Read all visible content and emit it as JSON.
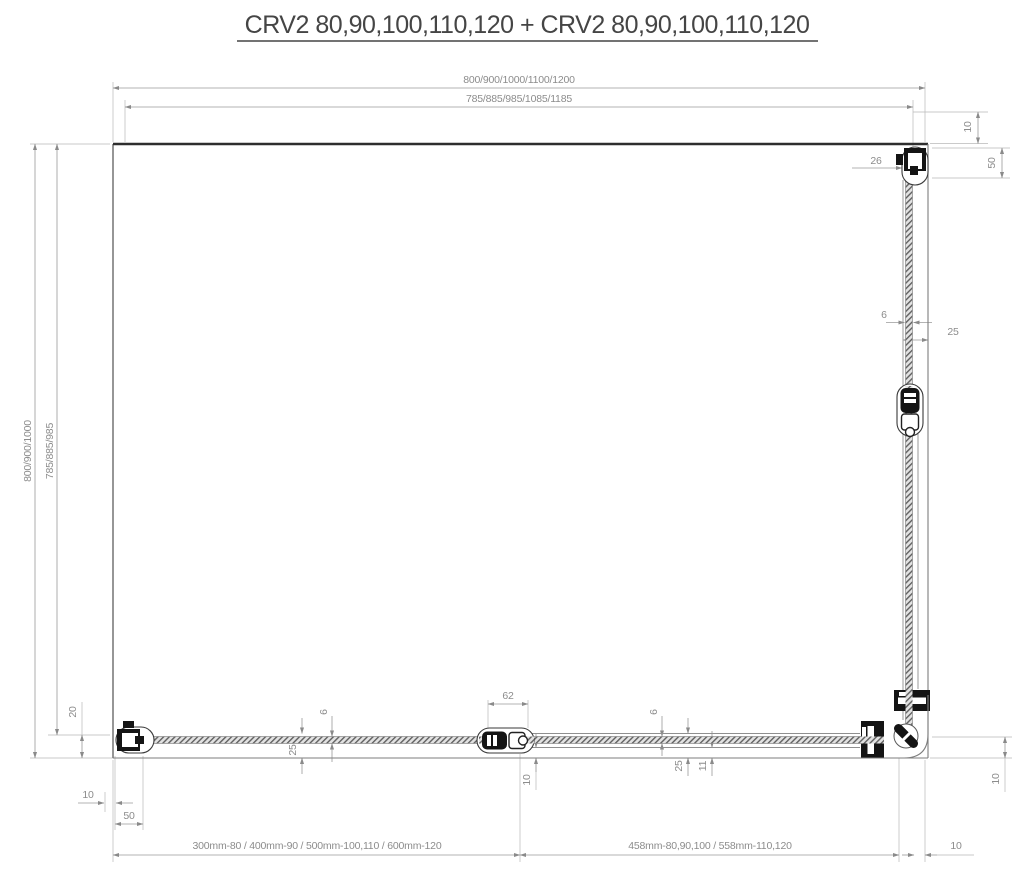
{
  "title": "CRV2 80,90,100,110,120 + CRV2 80,90,100,110,120",
  "colors": {
    "line_gray": "#8a8a8a",
    "dimension_text": "#8c8c8c",
    "wall_dark": "#2e2e2e",
    "fitting_black": "#141414",
    "background": "#ffffff"
  },
  "dims": {
    "width_total": "800/900/1000/1100/1200",
    "width_glass": "785/885/985/1085/1185",
    "height_total": "800/900/1000",
    "height_glass": "785/885/985",
    "top_right_wall_gap": "10",
    "top_right_hinge_offset": "26",
    "top_right_profile_depth": "50",
    "right_glass_thickness": "6",
    "right_profile_width": "25",
    "left_bottom_glass_offset": "20",
    "bottom_left_wall_gap": "10",
    "bottom_left_profile_depth": "50",
    "door_overlap": "62",
    "bottom_glass_thickness_left": "6",
    "bottom_profile_width_left": "25",
    "bottom_center_gap": "10",
    "bottom_glass_thickness_right": "6",
    "bottom_profile_width_right": "25",
    "bottom_panel_offset": "11",
    "bottom_right_corner_gap": "10",
    "door_width_range": "300mm-80 / 400mm-90 / 500mm-100,110 / 600mm-120",
    "fixed_width_range": "458mm-80,90,100 / 558mm-110,120",
    "bottom_right_wall_gap": "10"
  }
}
